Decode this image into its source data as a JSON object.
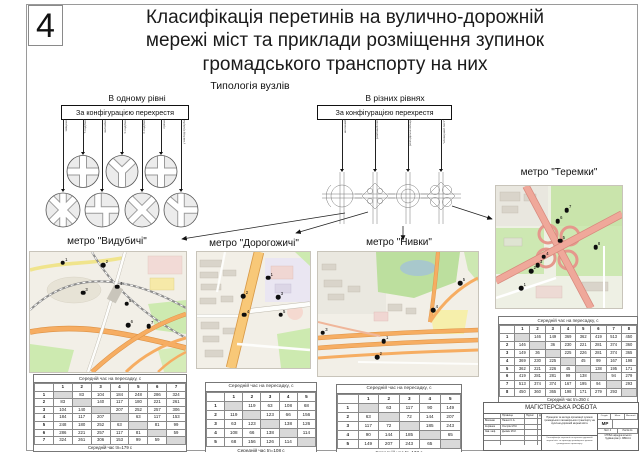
{
  "page": {
    "sheet_number": "4"
  },
  "title": {
    "line1": "Класифікація перетинів на вулично-дорожній",
    "line2": "мережі міст та приклади розміщення зупинок",
    "line3": "громадського транспорту на них"
  },
  "typology": {
    "label": "Типологія вузлів",
    "left": {
      "heading": "В одному рівні",
      "box_label": "За конфігурацією перехрестя",
      "branches": {
        "labels": [
          "зміщене",
          "Т-подібне",
          "звичайне",
          "У-подібне",
          "Х-подібне",
          "пряме",
          "у вигляді тризуба"
        ],
        "lens": [
          70,
          33,
          70,
          33,
          70,
          33,
          70
        ]
      }
    },
    "right": {
      "heading": "В різних рівнях",
      "box_label": "За конфігурацією перехрестя",
      "branches": {
        "labels": [
          "неповний",
          "ромбовий тип",
          "розподільче кільце",
          "\"клеверний лист\""
        ],
        "lens": [
          50,
          50,
          50,
          50
        ]
      }
    }
  },
  "table_caption": "Середній час на пересадку, с",
  "examples": {
    "vydubychi": {
      "name": "метро \"Видубичі\"",
      "footer": "Середній час tп=179 с",
      "matrix": [
        [
          null,
          83,
          104,
          184,
          248,
          286,
          324
        ],
        [
          83,
          null,
          140,
          117,
          180,
          221,
          261
        ],
        [
          104,
          140,
          null,
          207,
          252,
          257,
          306
        ],
        [
          184,
          117,
          207,
          null,
          63,
          117,
          153
        ],
        [
          248,
          180,
          252,
          63,
          null,
          81,
          99
        ],
        [
          286,
          221,
          257,
          117,
          81,
          null,
          59
        ],
        [
          324,
          261,
          306,
          153,
          99,
          59,
          null
        ]
      ],
      "stops": [
        {
          "n": 1,
          "x": 21,
          "y": 9
        },
        {
          "n": 2,
          "x": 47,
          "y": 11
        },
        {
          "n": 3,
          "x": 34,
          "y": 34
        },
        {
          "n": 4,
          "x": 56,
          "y": 29
        },
        {
          "n": 5,
          "x": 62,
          "y": 43
        },
        {
          "n": 6,
          "x": 63,
          "y": 61
        },
        {
          "n": 7,
          "x": 76,
          "y": 62
        }
      ]
    },
    "dorohozhychi": {
      "name": "метро \"Дорогожичі\"",
      "footer": "Середній час tп=108 с",
      "matrix": [
        [
          null,
          119,
          63,
          108,
          68
        ],
        [
          119,
          null,
          123,
          66,
          156
        ],
        [
          63,
          123,
          null,
          138,
          126
        ],
        [
          108,
          66,
          138,
          null,
          114
        ],
        [
          68,
          156,
          126,
          114,
          null
        ]
      ],
      "stops": [
        {
          "n": 1,
          "x": 63,
          "y": 22
        },
        {
          "n": 2,
          "x": 41,
          "y": 38
        },
        {
          "n": 3,
          "x": 72,
          "y": 39
        },
        {
          "n": 4,
          "x": 42,
          "y": 54
        },
        {
          "n": 5,
          "x": 74,
          "y": 54
        }
      ]
    },
    "nyvky": {
      "name": "метро \"Нивки\"",
      "footer": "Середній час tп=133 с",
      "matrix": [
        [
          null,
          63,
          117,
          90,
          149
        ],
        [
          63,
          null,
          72,
          144,
          207
        ],
        [
          117,
          72,
          null,
          185,
          243
        ],
        [
          90,
          144,
          185,
          null,
          65
        ],
        [
          149,
          207,
          243,
          65,
          null
        ]
      ],
      "stops": [
        {
          "n": 1,
          "x": 41,
          "y": 72
        },
        {
          "n": 2,
          "x": 37,
          "y": 85
        },
        {
          "n": 3,
          "x": 3,
          "y": 65
        },
        {
          "n": 4,
          "x": 72,
          "y": 47
        },
        {
          "n": 5,
          "x": 89,
          "y": 25
        }
      ]
    },
    "teremky": {
      "name": "метро \"Теремки\"",
      "footer": "Середній час tп=250 с",
      "matrix": [
        [
          null,
          146,
          149,
          369,
          362,
          419,
          513,
          450
        ],
        [
          146,
          null,
          36,
          230,
          221,
          281,
          374,
          360
        ],
        [
          149,
          36,
          null,
          225,
          226,
          281,
          374,
          365
        ],
        [
          369,
          230,
          225,
          null,
          45,
          99,
          167,
          198
        ],
        [
          362,
          221,
          226,
          45,
          null,
          138,
          195,
          171
        ],
        [
          419,
          281,
          281,
          99,
          138,
          null,
          94,
          279
        ],
        [
          513,
          374,
          374,
          167,
          195,
          94,
          null,
          293
        ],
        [
          450,
          360,
          365,
          198,
          171,
          279,
          293,
          null
        ]
      ],
      "stops": [
        {
          "n": 1,
          "x": 20,
          "y": 84
        },
        {
          "n": 2,
          "x": 28,
          "y": 70
        },
        {
          "n": 3,
          "x": 33,
          "y": 65
        },
        {
          "n": 4,
          "x": 38,
          "y": 58
        },
        {
          "n": 5,
          "x": 51,
          "y": 45
        },
        {
          "n": 6,
          "x": 49,
          "y": 29
        },
        {
          "n": 7,
          "x": 56,
          "y": 20
        },
        {
          "n": 8,
          "x": 79,
          "y": 50
        }
      ]
    }
  },
  "stamp": {
    "title": "МАГІСТЕРСЬКА РОБОТА",
    "people_header": {
      "c1": "",
      "c2": "Прізвище",
      "c3": "Підпис",
      "c4": "Дата"
    },
    "people": [
      {
        "role": "Виконав",
        "name": "Пашко С.А."
      },
      {
        "role": "Керівник",
        "name": "Осєтрін М.М."
      },
      {
        "role": "Зав. каф.",
        "name": "Дьомін М.М."
      }
    ],
    "theme": "Принципи та методи організації зупинок громадського пасажирського транспорту на вулично-дорожній мережі міста",
    "sheet_name": "Класифікація перетинів на вулично-дорожній мережі міст та приклади розміщення зупинок громадського транспорту",
    "right_header": {
      "h1": "Стадія",
      "h2": "Маса",
      "h3": "Масштаб"
    },
    "stage": "МР",
    "sheet_no": "Лист 4",
    "sheets_total": "Листів 11",
    "org": "КНУБА кафедра міського будівництва гр. МБМ-41"
  },
  "colors": {
    "road_orange": "#f4a75e",
    "road_salmon": "#efa89a",
    "map_green": "#cdeab0",
    "table_diagonal": "#d9d9d9"
  }
}
